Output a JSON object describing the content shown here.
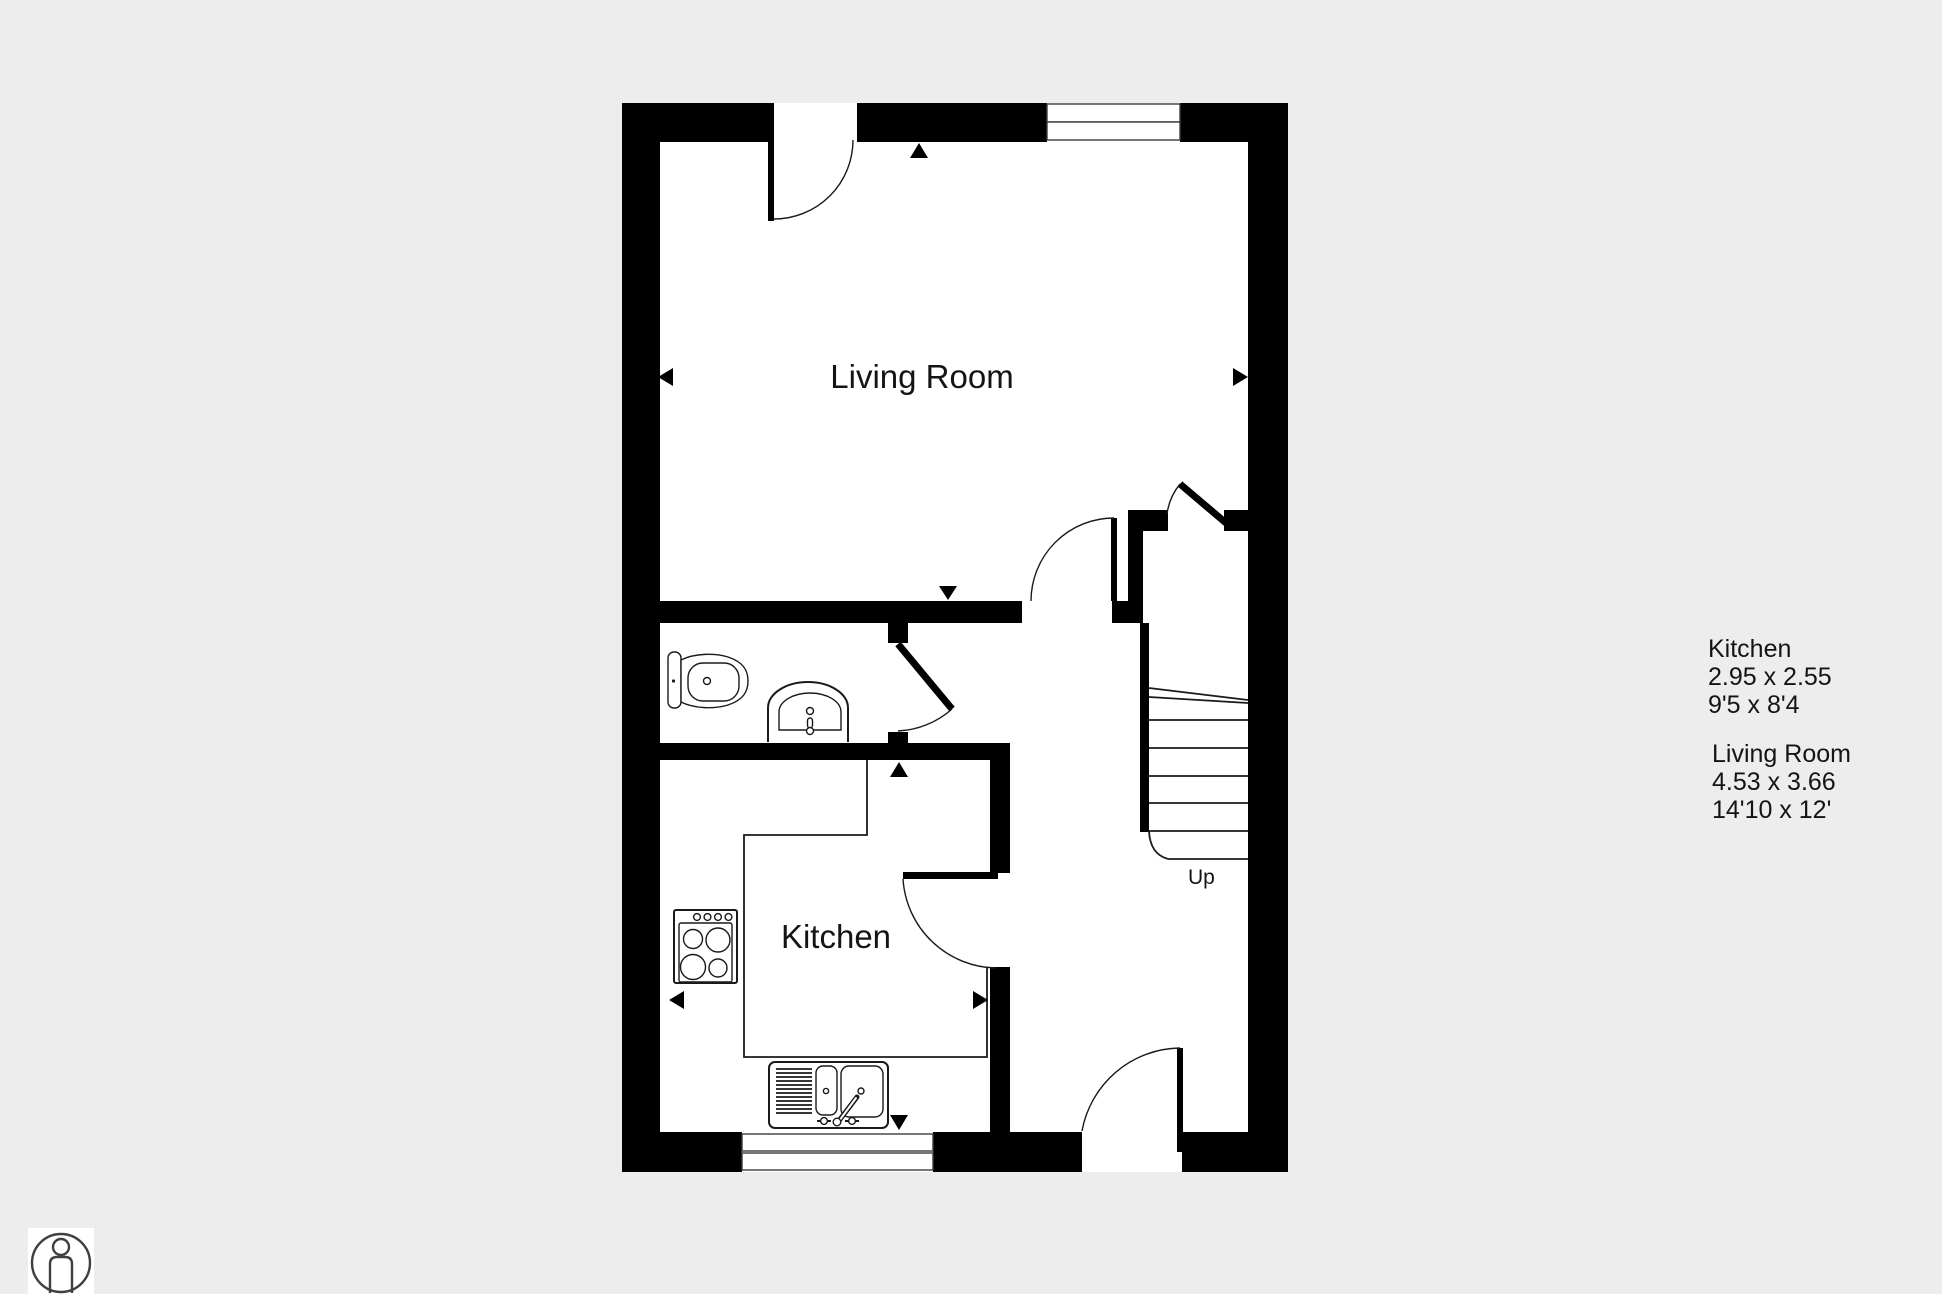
{
  "canvas": {
    "background_color": "#ededed",
    "floor_color": "#ffffff",
    "wall_color": "#000000"
  },
  "rooms": {
    "living_room_label": "Living Room",
    "kitchen_label": "Kitchen"
  },
  "stairs": {
    "direction_label": "Up"
  },
  "dimension_labels": {
    "kitchen": {
      "name": "Kitchen",
      "metric": "2.95 x 2.55",
      "imperial": "9'5 x 8'4"
    },
    "living_room": {
      "name": "Living Room",
      "metric": "4.53 x 3.66",
      "imperial": "14'10 x 12'"
    }
  },
  "icons": {
    "person_badge": "person-in-circle"
  }
}
